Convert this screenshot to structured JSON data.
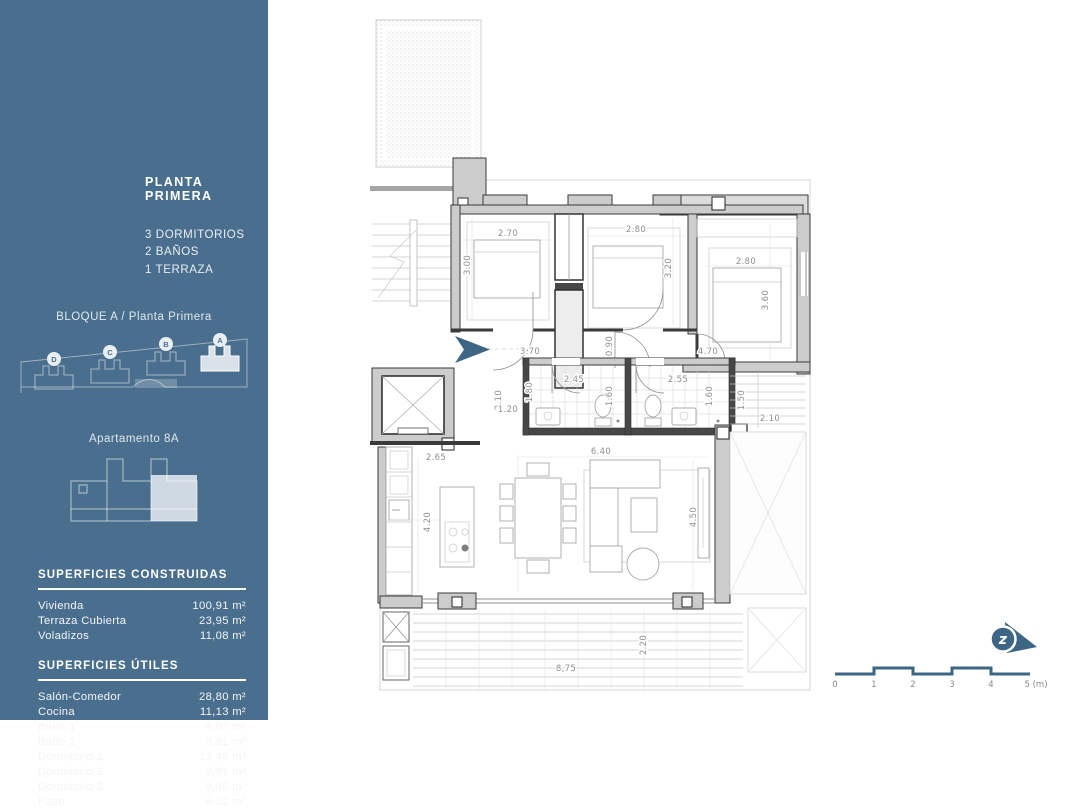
{
  "theme": {
    "sidebar_bg": "#4a6f8e",
    "accent": "#3d6584",
    "wall_dark": "#3a3a3a",
    "dim_text": "#8f8f8f"
  },
  "sidebar": {
    "title": "PLANTA PRIMERA",
    "features": [
      "3 DORMITORIOS",
      "2 BAÑOS",
      "1 TERRAZA"
    ],
    "block_title": "BLOQUE A / Planta Primera",
    "site_blocks": [
      {
        "letter": "D"
      },
      {
        "letter": "C"
      },
      {
        "letter": "B"
      },
      {
        "letter": "A"
      }
    ],
    "apartment_title": "Apartamento 8A",
    "constructed": {
      "title": "SUPERFICIES CONSTRUIDAS",
      "rows": [
        {
          "label": "Vivienda",
          "value": "100,91 m²"
        },
        {
          "label": "Terraza Cubierta",
          "value": "23,95 m²"
        },
        {
          "label": "Voladizos",
          "value": "11,08 m²"
        }
      ]
    },
    "useful": {
      "title": "SUPERFICIES ÚTILES",
      "rows": [
        {
          "label": "Salón-Comedor",
          "value": "28,80 m²"
        },
        {
          "label": "Cocina",
          "value": "11,13 m²"
        },
        {
          "label": "Baño 1",
          "value": "4,07 m²"
        },
        {
          "label": "Baño 2",
          "value": "3,91 m²"
        },
        {
          "label": "Dormitorio 1",
          "value": "13,45 m²"
        },
        {
          "label": "Dormitorio 2",
          "value": "9,81 m²"
        },
        {
          "label": "Dormitorio 3",
          "value": "8,96 m²"
        },
        {
          "label": "Paso",
          "value": "6,52 m²"
        }
      ]
    }
  },
  "plan": {
    "dims": [
      {
        "t": "2.70"
      },
      {
        "t": "3.00"
      },
      {
        "t": "2.80"
      },
      {
        "t": "3.20"
      },
      {
        "t": "2.80"
      },
      {
        "t": "3.60"
      },
      {
        "t": "3.70"
      },
      {
        "t": "0.90"
      },
      {
        "t": "4.70"
      },
      {
        "t": "2.45"
      },
      {
        "t": "1.80"
      },
      {
        "t": "1.60"
      },
      {
        "t": "2.55"
      },
      {
        "t": "1.60"
      },
      {
        "t": "2.10"
      },
      {
        "t": "1.20"
      },
      {
        "t": "1.50"
      },
      {
        "t": "2.10"
      },
      {
        "t": "2.65"
      },
      {
        "t": "6.40"
      },
      {
        "t": "4.20"
      },
      {
        "t": "4.50"
      },
      {
        "t": "2.20"
      },
      {
        "t": "8,75"
      }
    ]
  },
  "scalebar": {
    "labels": [
      "0",
      "1",
      "2",
      "3",
      "4",
      "5 (m)"
    ]
  },
  "north": {
    "letter": "z"
  }
}
